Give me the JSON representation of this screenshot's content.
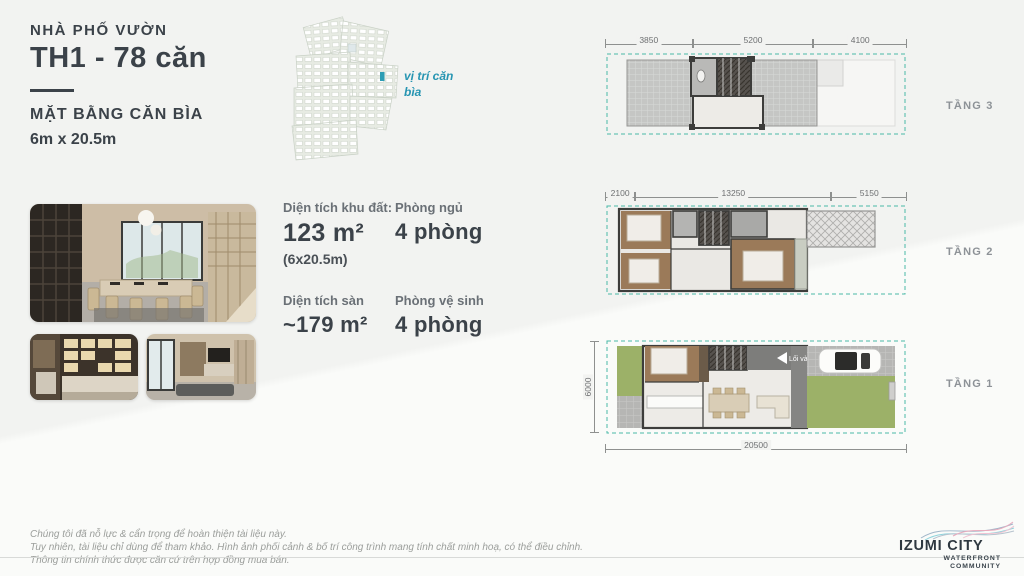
{
  "header": {
    "category": "NHÀ PHỐ VƯỜN",
    "title": "TH1 - 78 căn",
    "subtitle": "MẶT BẰNG CĂN BÌA",
    "size": "6m x 20.5m"
  },
  "siteplan": {
    "marker_label": "vị trí căn bìa",
    "marker_color": "#2d9db4"
  },
  "specs": {
    "land_area_label": "Diện tích khu đất:",
    "land_area_value": "123 m²",
    "land_area_dims": "(6x20.5m)",
    "bedrooms_label": "Phòng ngủ",
    "bedrooms_value": "4 phòng",
    "floor_area_label": "Diện tích sàn",
    "floor_area_value": "~179 m²",
    "bathrooms_label": "Phòng vệ sinh",
    "bathrooms_value": "4 phòng"
  },
  "floorplans": [
    {
      "label": "TẦNG 3",
      "dims_top": [
        "3850",
        "5200",
        "4100"
      ]
    },
    {
      "label": "TẦNG 2",
      "dims_top": [
        "2100",
        "13250",
        "5150"
      ]
    },
    {
      "label": "TẦNG 1",
      "dim_bottom": "20500",
      "dim_left": "6000",
      "entry_label": "Lối vào"
    }
  ],
  "footer": {
    "disclaimer_line1": "Chúng tôi đã nỗ lực & cẩn trọng để hoàn thiện tài liệu này.",
    "disclaimer_line2": "Tuy nhiên, tài liệu chỉ dùng để tham khảo. Hình ảnh phối cảnh & bố trí công trình mang tính chất minh hoạ, có thể điều chỉnh.",
    "disclaimer_line3": "Thông tin chính thức được căn cứ trên hợp đồng mua bán.",
    "logo_title": "IZUMI CITY",
    "logo_sub1": "WATERFRONT",
    "logo_sub2": "COMMUNITY"
  },
  "colors": {
    "accent_teal": "#2d9db4",
    "boundary_teal": "#49b8a8",
    "text_dark": "#3b4249",
    "text_gray": "#8d9297"
  }
}
